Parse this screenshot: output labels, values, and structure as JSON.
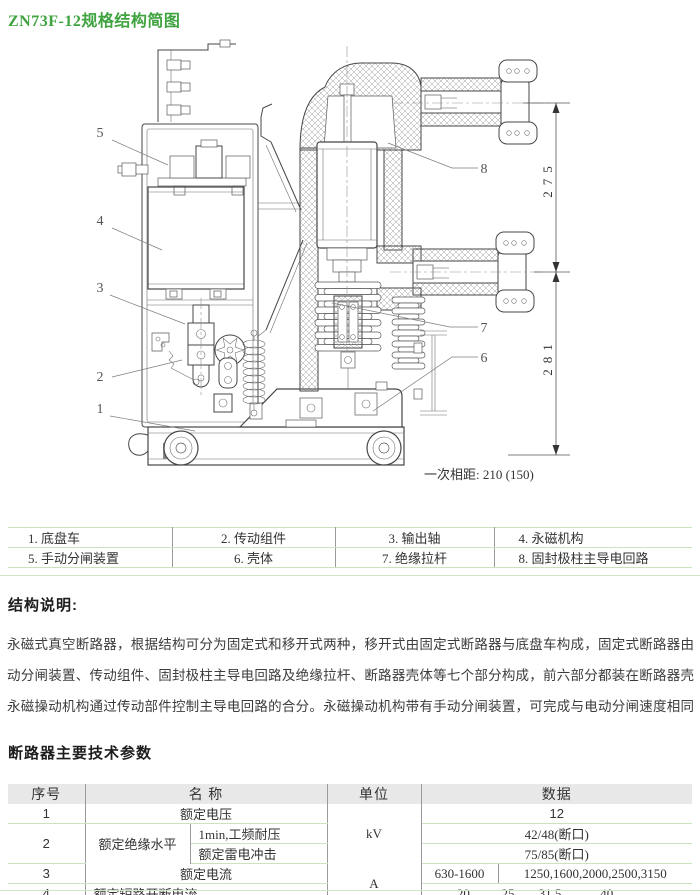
{
  "title": "ZN73F-12规格结构简图",
  "drawing": {
    "caption": "一次相距: 210 (150)",
    "dim_upper": "275",
    "dim_lower": "281",
    "parts": {
      "p1": "1",
      "p2": "2",
      "p3": "3",
      "p4": "4",
      "p5": "5",
      "p6": "6",
      "p7": "7",
      "p8": "8"
    }
  },
  "legend": {
    "row1": [
      "1. 底盘车",
      "2. 传动组件",
      "3. 输出轴",
      "4. 永磁机构"
    ],
    "row2": [
      "5. 手动分闸装置",
      "6. 壳体",
      "7. 绝缘拉杆",
      "8. 固封极柱主导电回路"
    ]
  },
  "structure": {
    "heading": "结构说明:",
    "lines": [
      "永磁式真空断路器，根据结构可分为固定式和移开式两种，移开式由固定式断路器与底盘车构成，固定式断路器由永磁操动机构、手",
      "动分闸装置、传动组件、固封极柱主导电回路及绝缘拉杆、断路器壳体等七个部分构成，前六部分都装在断路器壳体内。",
      "永磁操动机构通过传动部件控制主导电回路的合分。永磁操动机构带有手动分闸装置，可完成与电动分闸速度相同的分闸动作，可作"
    ]
  },
  "params": {
    "heading": "断路器主要技术参数",
    "headers": {
      "no": "序号",
      "name": "名 称",
      "unit": "单位",
      "data": "数据"
    },
    "rows": {
      "r1": {
        "no": "1",
        "name": "额定电压",
        "unit": "kV",
        "data": "12"
      },
      "r2": {
        "no": "2",
        "name": "额定绝缘水平",
        "sub1": "1min,工频耐压",
        "sub2": "额定雷电冲击",
        "data1": "42/48(断口)",
        "data2": "75/85(断口)"
      },
      "r3": {
        "no": "3",
        "name": "额定电流",
        "unit": "A",
        "data1": "630-1600",
        "data2": "1250,1600,2000,2500,3150"
      },
      "r4": {
        "no": "4",
        "name": "额定短路开断电流",
        "values": [
          "20",
          "25",
          "31.5",
          "40"
        ]
      }
    }
  }
}
